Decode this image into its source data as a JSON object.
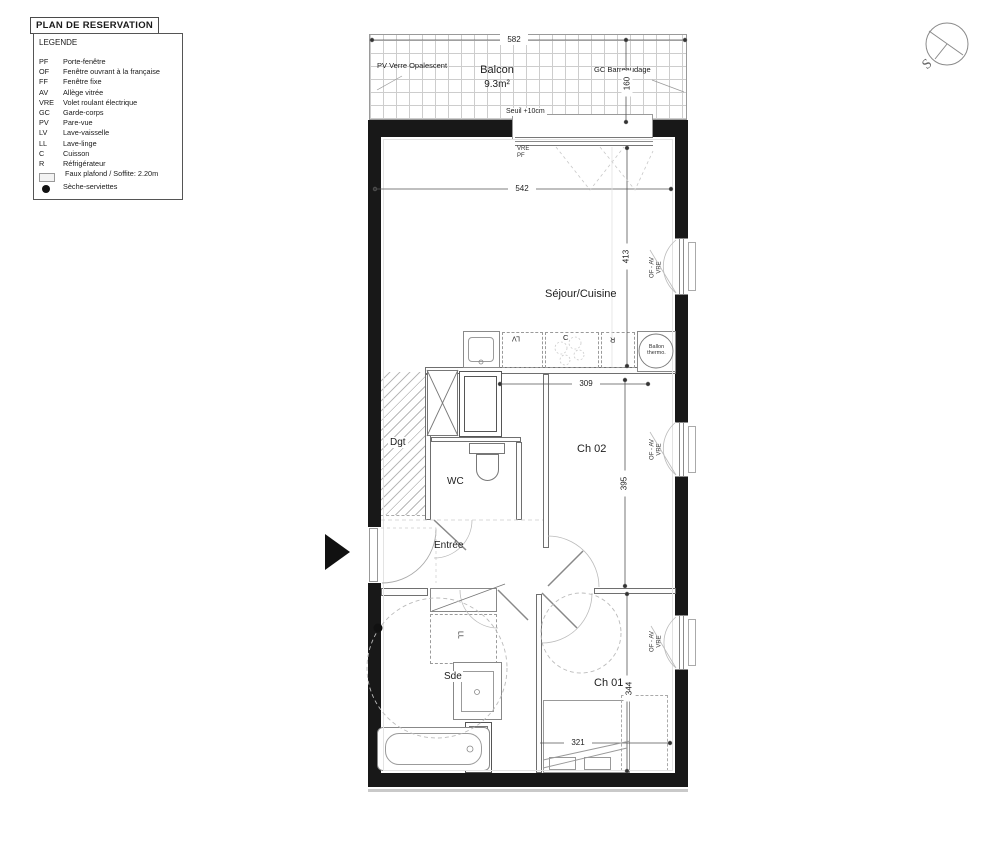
{
  "title": "PLAN DE RESERVATION",
  "legend": {
    "title": "LEGENDE",
    "items": [
      {
        "abbr": "PF",
        "label": "Porte-fenêtre"
      },
      {
        "abbr": "OF",
        "label": "Fenêtre ouvrant à la française"
      },
      {
        "abbr": "FF",
        "label": "Fenêtre fixe"
      },
      {
        "abbr": "AV",
        "label": "Allège vitrée"
      },
      {
        "abbr": "VRE",
        "label": "Volet roulant électrique"
      },
      {
        "abbr": "GC",
        "label": "Garde-corps"
      },
      {
        "abbr": "PV",
        "label": "Pare-vue"
      },
      {
        "abbr": "LV",
        "label": "Lave-vaisselle"
      },
      {
        "abbr": "LL",
        "label": "Lave-linge"
      },
      {
        "abbr": "C",
        "label": "Cuisson"
      },
      {
        "abbr": "R",
        "label": "Réfrigérateur"
      }
    ],
    "faux_plafond": "Faux plafond / Soffite: 2.20m",
    "seche_serviettes": "Sèche-serviettes"
  },
  "compass": {
    "south": "S"
  },
  "balcony": {
    "name": "Balcon",
    "area": "9.3m²",
    "left_note": "PV Verre Opalescent",
    "right_note": "GC Barreaudage",
    "seuil": "Seuil +10cm"
  },
  "rooms": {
    "sejour": "Séjour/Cuisine",
    "dgt": "Dgt",
    "wc": "WC",
    "entree": "Entrée",
    "ch02": "Ch 02",
    "sde": "Sde",
    "ch01": "Ch 01"
  },
  "fixtures": {
    "ballon_line1": "Ballon",
    "ballon_line2": "thermo.",
    "lv": "LV",
    "ll": "LL",
    "cuisson": "C",
    "refrigerateur": "R"
  },
  "window_labels": {
    "top_line1": "VRE",
    "top_line2": "PF",
    "side_line1": "OF - AV",
    "side_line2": "VRE"
  },
  "dimensions": {
    "balcony_width": "582",
    "balcony_depth": "160",
    "sejour_width": "542",
    "sejour_height": "413",
    "kitchen_width": "309",
    "ch02_height": "395",
    "ch01_height": "344",
    "ch01_width": "321"
  },
  "colors": {
    "wall": "#181818",
    "line": "#999999"
  }
}
